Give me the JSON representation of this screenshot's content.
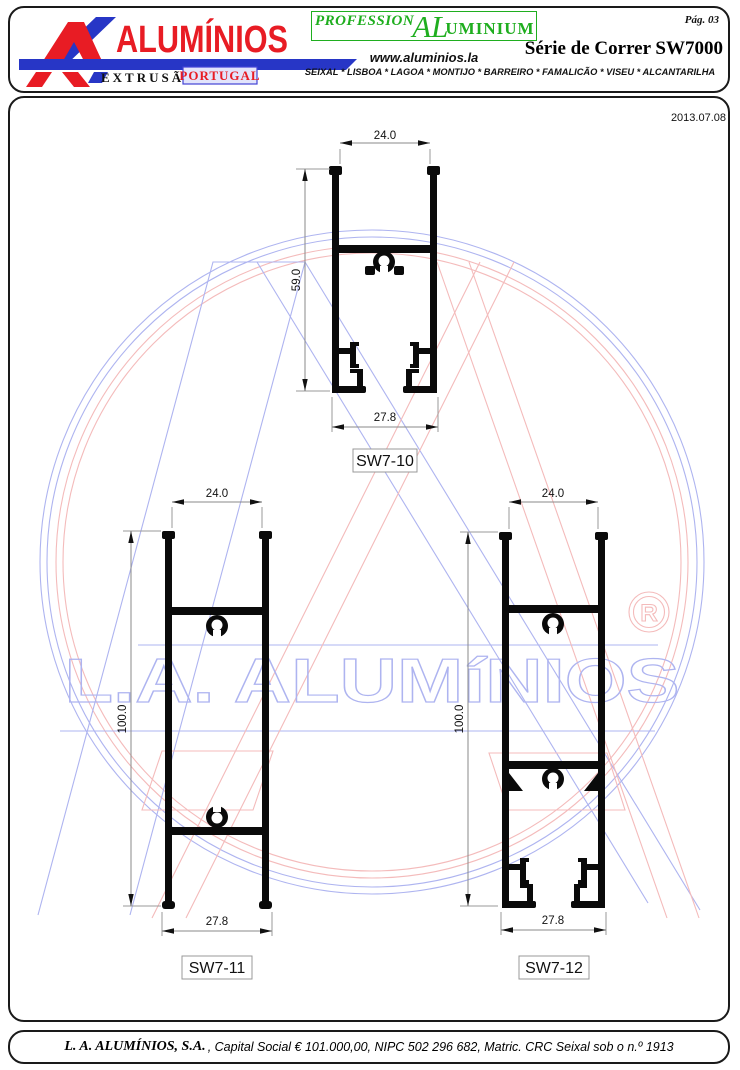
{
  "header": {
    "page_number": "Pág. 03",
    "brand_wordmark": "ALUMÍNIOS",
    "brand_sub": "EXTRUSÃO",
    "brand_badge": "PORTUGAL",
    "professional_segments": {
      "a": "PROFESSION",
      "b": "AL",
      "c": "UMINIUM"
    },
    "website": "www.aluminios.la",
    "series_title": "Série de Correr SW7000",
    "locations": "SEIXAL * LISBOA * LAGOA * MONTIJO * BARREIRO * FAMALICÃO * VISEU * ALCANTARILHA"
  },
  "drawing": {
    "date": "2013.07.08",
    "profiles": [
      {
        "id": "SW7-10",
        "width_top": "24.0",
        "height": "59.0",
        "width_bottom": "27.8"
      },
      {
        "id": "SW7-11",
        "width_top": "24.0",
        "height": "100.0",
        "width_bottom": "27.8"
      },
      {
        "id": "SW7-12",
        "width_top": "24.0",
        "height": "100.0",
        "width_bottom": "27.8"
      }
    ]
  },
  "watermark": {
    "text": "L.A. ALUMíNIOS",
    "registered_symbol": "R",
    "colors": {
      "blue": "#aeb4f0",
      "pink": "#f4bbbb"
    }
  },
  "footer": {
    "company": "L. A. ALUMÍNIOS, S.A.",
    "details": ", Capital Social € 101.000,00, NIPC 502 296 682, Matric. CRC Seixal sob o n.º 1913"
  }
}
